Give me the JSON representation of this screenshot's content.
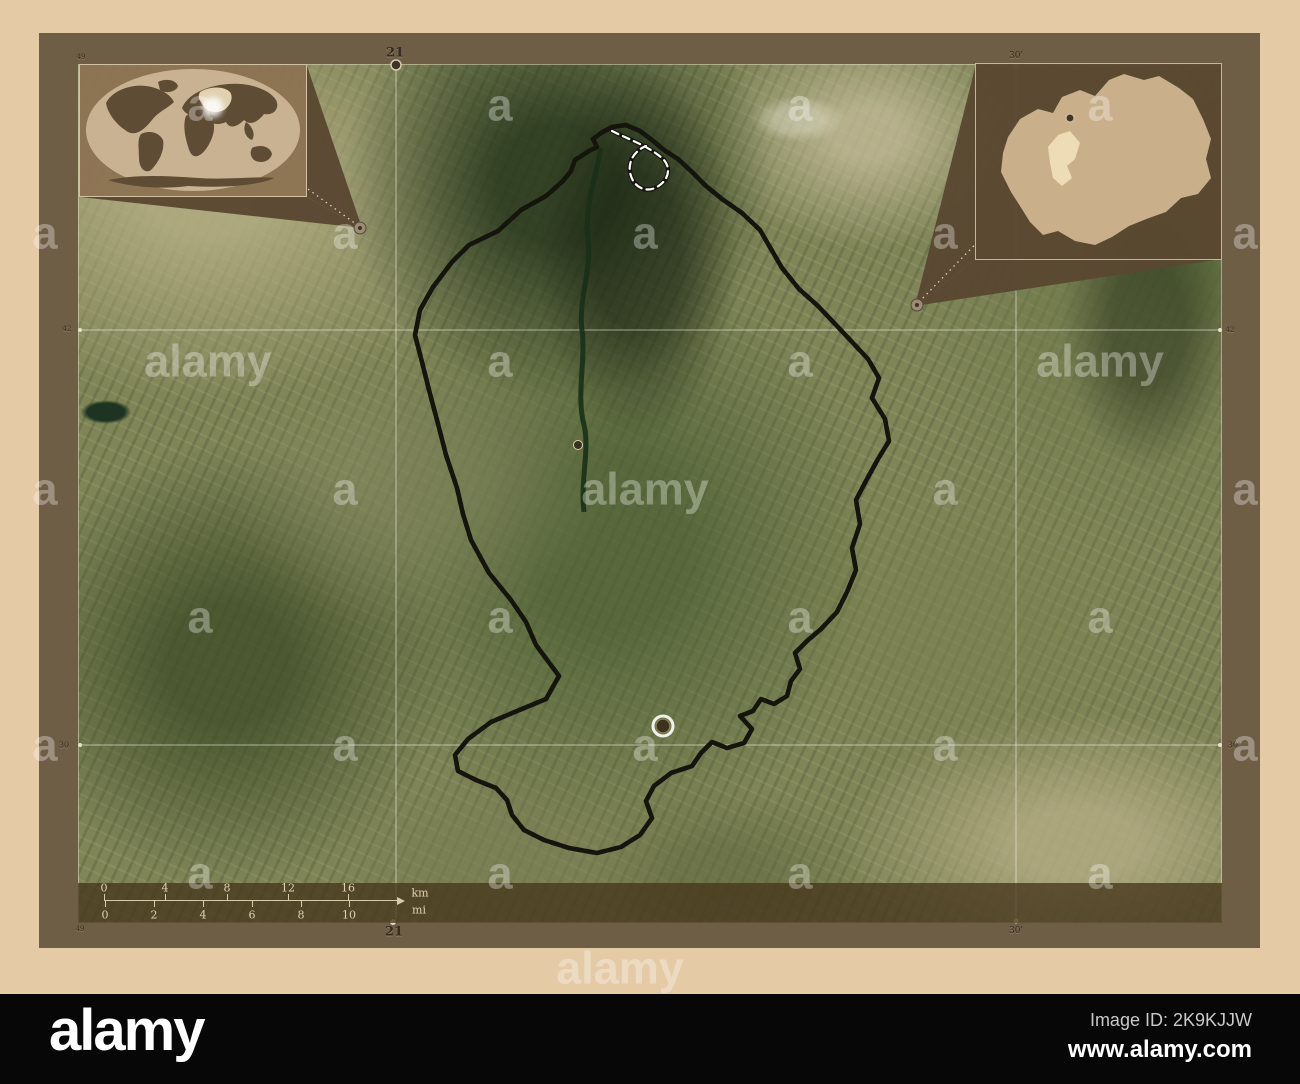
{
  "branding": {
    "logo": "alamy",
    "image_id": "Image ID: 2K9KJJW",
    "url": "www.alamy.com"
  },
  "watermark": {
    "letter": "a",
    "word": "alamy",
    "items": [
      {
        "t": "a",
        "x": 200,
        "y": 105
      },
      {
        "t": "a",
        "x": 500,
        "y": 105
      },
      {
        "t": "a",
        "x": 800,
        "y": 105
      },
      {
        "t": "a",
        "x": 1100,
        "y": 105
      },
      {
        "t": "a",
        "x": 45,
        "y": 233
      },
      {
        "t": "a",
        "x": 345,
        "y": 233
      },
      {
        "t": "a",
        "x": 645,
        "y": 233
      },
      {
        "t": "a",
        "x": 945,
        "y": 233
      },
      {
        "t": "a",
        "x": 1245,
        "y": 233
      },
      {
        "t": "alamy",
        "x": 208,
        "y": 361
      },
      {
        "t": "a",
        "x": 500,
        "y": 361
      },
      {
        "t": "a",
        "x": 800,
        "y": 361
      },
      {
        "t": "alamy",
        "x": 1100,
        "y": 361
      },
      {
        "t": "a",
        "x": 45,
        "y": 489
      },
      {
        "t": "a",
        "x": 345,
        "y": 489
      },
      {
        "t": "alamy",
        "x": 645,
        "y": 489
      },
      {
        "t": "a",
        "x": 945,
        "y": 489
      },
      {
        "t": "a",
        "x": 1245,
        "y": 489
      },
      {
        "t": "a",
        "x": 200,
        "y": 617
      },
      {
        "t": "a",
        "x": 500,
        "y": 617
      },
      {
        "t": "a",
        "x": 800,
        "y": 617
      },
      {
        "t": "a",
        "x": 1100,
        "y": 617
      },
      {
        "t": "a",
        "x": 45,
        "y": 745
      },
      {
        "t": "a",
        "x": 345,
        "y": 745
      },
      {
        "t": "a",
        "x": 645,
        "y": 745
      },
      {
        "t": "a",
        "x": 945,
        "y": 745
      },
      {
        "t": "a",
        "x": 1245,
        "y": 745
      },
      {
        "t": "a",
        "x": 200,
        "y": 873
      },
      {
        "t": "a",
        "x": 500,
        "y": 873
      },
      {
        "t": "a",
        "x": 800,
        "y": 873
      },
      {
        "t": "a",
        "x": 1100,
        "y": 873
      },
      {
        "t": "alamy",
        "x": 620,
        "y": 968
      }
    ]
  },
  "graticule": {
    "labels": [
      {
        "text": "49",
        "x": 81,
        "y": 57,
        "size": 7,
        "bold": false
      },
      {
        "text": "21",
        "x": 395,
        "y": 53,
        "size": 13,
        "bold": true
      },
      {
        "text": "30'",
        "x": 1016,
        "y": 56,
        "size": 9,
        "bold": false
      },
      {
        "text": "49",
        "x": 80,
        "y": 929,
        "size": 7,
        "bold": false
      },
      {
        "text": "21",
        "x": 394,
        "y": 932,
        "size": 13,
        "bold": true
      },
      {
        "text": "30'",
        "x": 1016,
        "y": 931,
        "size": 9,
        "bold": false
      },
      {
        "text": "42",
        "x": 67,
        "y": 329,
        "size": 7,
        "bold": false
      },
      {
        "text": "30",
        "x": 64,
        "y": 745,
        "size": 8,
        "bold": false
      },
      {
        "text": "42",
        "x": 1230,
        "y": 330,
        "size": 7,
        "bold": false
      },
      {
        "text": "30'",
        "x": 1234,
        "y": 745,
        "size": 8,
        "bold": false
      }
    ]
  },
  "scalebar": {
    "km_unit": "km",
    "mi_unit": "mi",
    "km_ticks": [
      {
        "v": "0",
        "x": 104
      },
      {
        "v": "4",
        "x": 165
      },
      {
        "v": "8",
        "x": 227
      },
      {
        "v": "12",
        "x": 288
      },
      {
        "v": "16",
        "x": 348
      }
    ],
    "mi_ticks": [
      {
        "v": "0",
        "x": 105
      },
      {
        "v": "2",
        "x": 154
      },
      {
        "v": "4",
        "x": 203
      },
      {
        "v": "6",
        "x": 252
      },
      {
        "v": "8",
        "x": 301
      },
      {
        "v": "10",
        "x": 349
      }
    ],
    "km_label_pos": {
      "x": 420,
      "y": 893
    },
    "mi_label_pos": {
      "x": 419,
      "y": 910
    }
  },
  "colors": {
    "mat": "#e4cba5",
    "frame": "#6f5e46",
    "black_bar": "#070707",
    "boundary_dash": "#ffffff",
    "boundary_casing": "#15150d",
    "pointer_fill": "#5a4832",
    "world_ocean": "#c9b292",
    "world_land": "#5f4c35",
    "country_fill": "#c9b08b",
    "municipality_fill": "#eedcb6"
  }
}
